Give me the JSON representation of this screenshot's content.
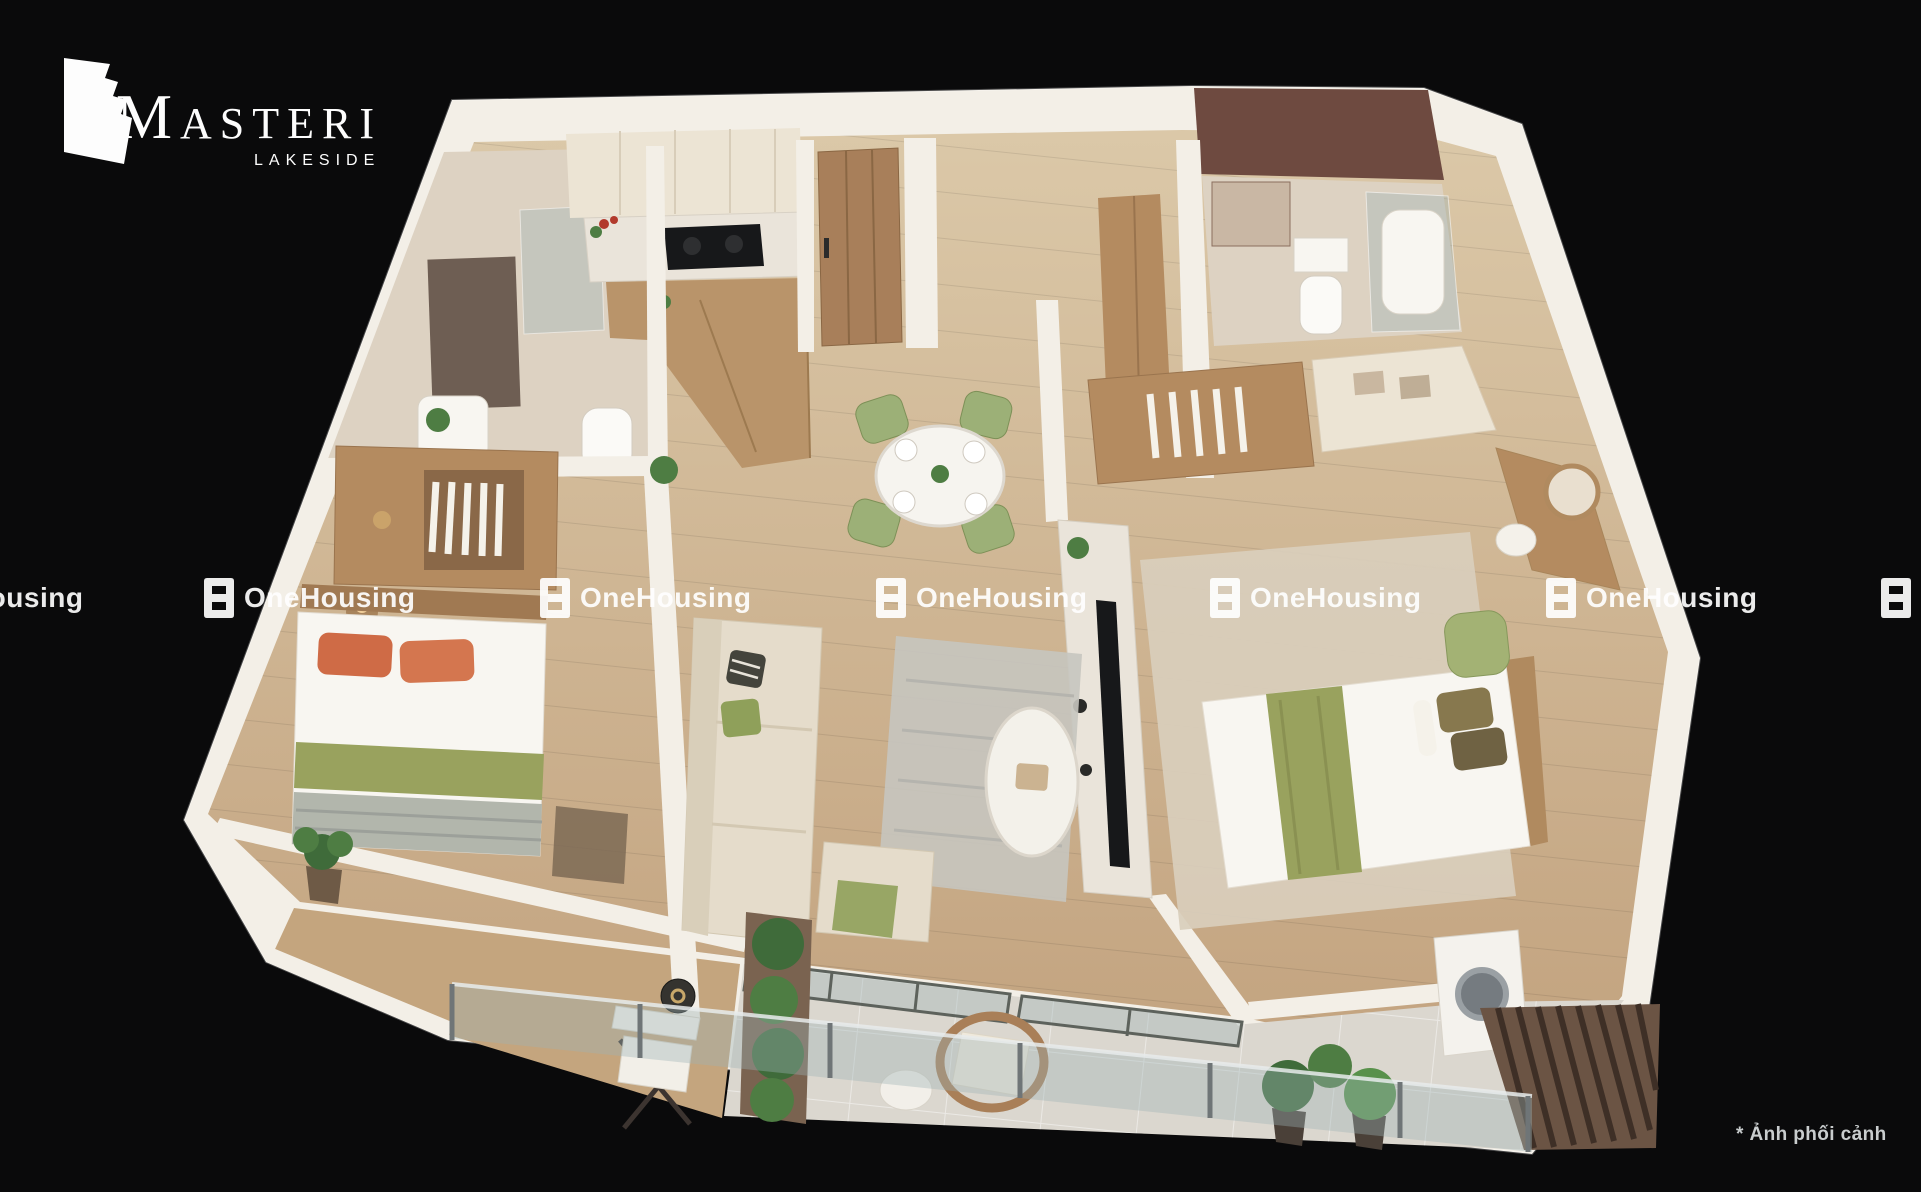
{
  "brand": {
    "name": "MASTERI",
    "subtitle": "LAKESIDE"
  },
  "watermark": {
    "label": "OneHousing",
    "icon": "onehousing-logo-icon"
  },
  "footnote": "* Ảnh phối cảnh",
  "palette": {
    "background": "#0a0a0b",
    "wall": "#f3efe7",
    "floor_tile": "#dbd7cf",
    "deck_wood": "#c4a57e",
    "bath_floor": "#ddd2c2",
    "bath_dark": "#6e4a40",
    "cabinet_cream": "#ece4d4",
    "counter_marble": "#eae4da",
    "island_wood": "#b9946a",
    "door_wood": "#a87f5a",
    "furniture_wood": "#b48b60",
    "bed_white": "#f8f6f1",
    "olive": "#99a25e",
    "orange": "#cf6b46",
    "blanket_gray": "#b2b6ac",
    "green_chair": "#9cb077",
    "sofa_beige": "#e5dccb",
    "rug_gray": "#c6c5bf",
    "glass": "#9fb4b6",
    "plant_green": "#4e7d43",
    "plant_dark": "#3f6b3a",
    "slat_brown": "#6b5444",
    "tv_black": "#17181a",
    "watermark_white": "#ffffff",
    "footnote_gray": "#c9cdce",
    "logo_white": "#fdfdfd"
  }
}
